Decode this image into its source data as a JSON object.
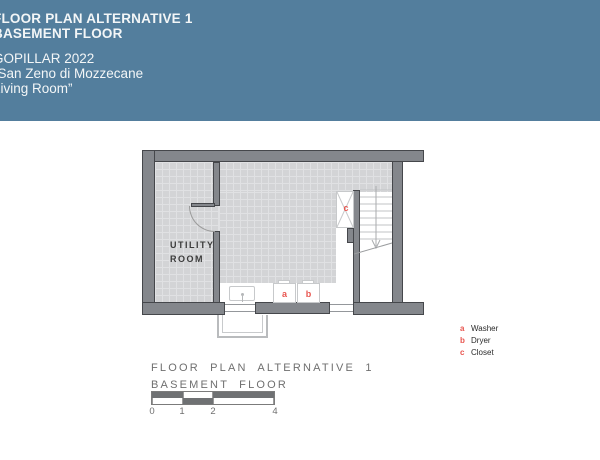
{
  "header": {
    "title_line1": "FLOOR PLAN ALTERNATIVE 1",
    "title_line2": "BASEMENT FLOOR",
    "subtitle_line1": "GOPILLAR 2022",
    "subtitle_line2": "“San Zeno di Mozzecane",
    "subtitle_line3": "Living Room”"
  },
  "plan": {
    "utility_room": {
      "line1": "UTILITY",
      "line2": "ROOM"
    },
    "markers": {
      "washer": "a",
      "dryer": "b",
      "closet": "c"
    }
  },
  "legend": {
    "items": [
      {
        "key": "a",
        "label": "Washer"
      },
      {
        "key": "b",
        "label": "Dryer"
      },
      {
        "key": "c",
        "label": "Closet"
      }
    ]
  },
  "caption": {
    "line1": "FLOOR PLAN ALTERNATIVE 1",
    "line2": "BASEMENT FLOOR"
  },
  "scale_bar": {
    "ticks": [
      "0",
      "1",
      "2",
      "4"
    ]
  },
  "colors": {
    "header_bg": "#537e9d",
    "wall_gray": "#84878c",
    "floor_gray": "#d3d4d6",
    "marker_red": "#e8554f"
  }
}
